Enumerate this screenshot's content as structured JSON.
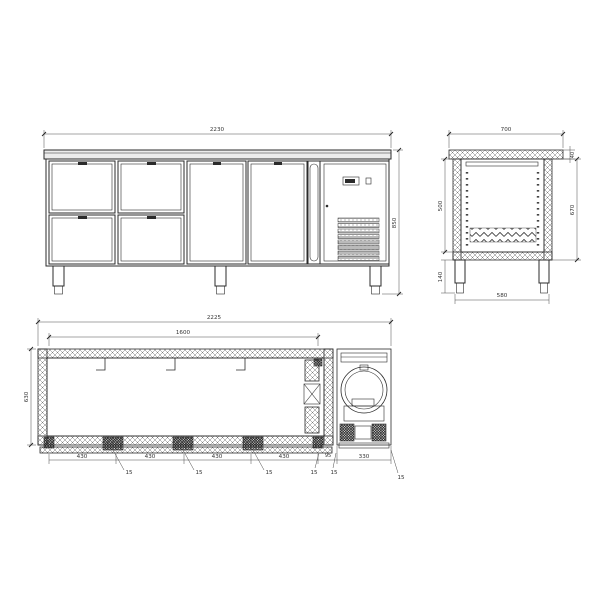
{
  "colors": {
    "line": "#2b2b2b",
    "dimension": "#4a4a4a",
    "surface": "#ececec",
    "background": "#ffffff"
  },
  "views": {
    "front": {
      "dims": {
        "overall_width": "2230",
        "overall_height": "850"
      }
    },
    "side": {
      "dims": {
        "overall_depth": "700",
        "top_thickness": "40",
        "inner_height": "500",
        "body_height": "670",
        "leg_height": "140",
        "base_depth": "580"
      }
    },
    "plan": {
      "dims": {
        "overall_width": "2225",
        "inner_width": "1600",
        "inner_depth": "630",
        "bay_widths": [
          "430",
          "430",
          "430",
          "430"
        ],
        "gap_width": "95",
        "machine_width": "330",
        "panel_thickness": "15"
      }
    }
  }
}
